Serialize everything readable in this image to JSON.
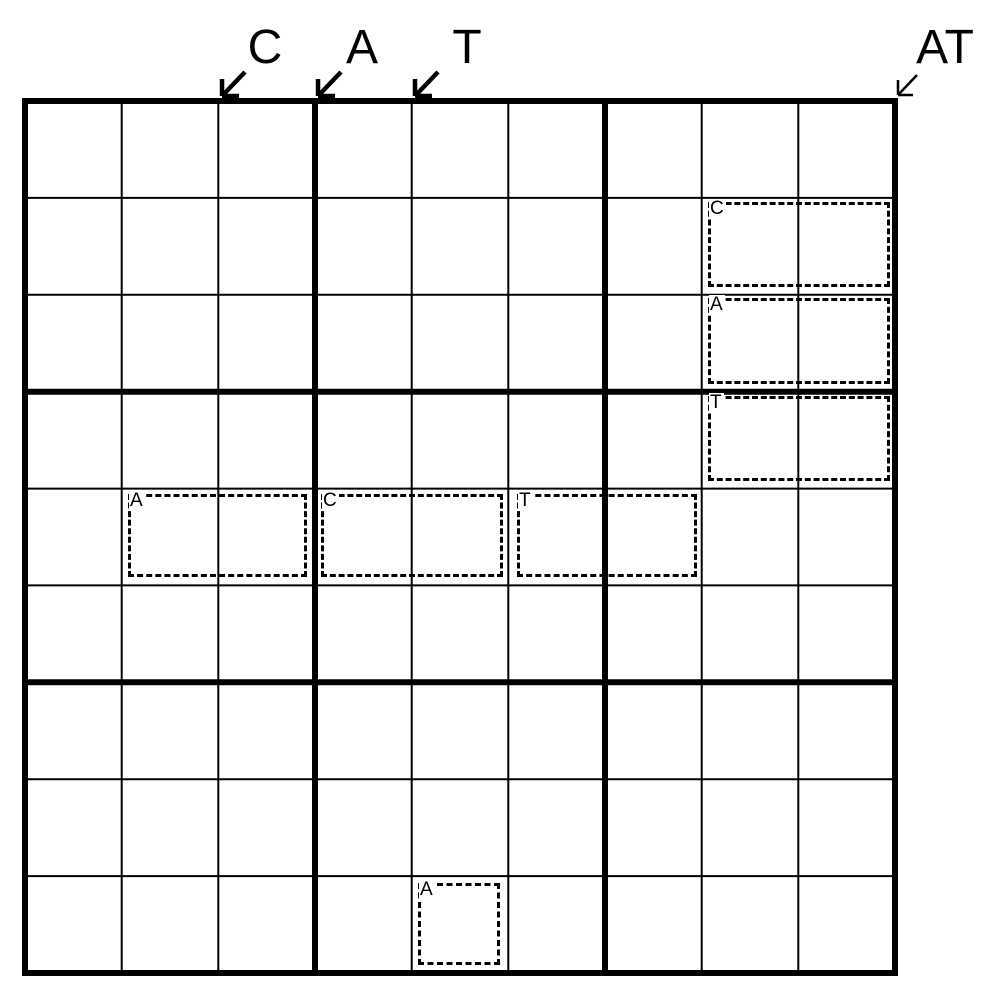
{
  "colors": {
    "ink": "#000000",
    "paper": "#ffffff"
  },
  "grid": {
    "rows": 9,
    "cols": 9,
    "box_rows": 3,
    "box_cols": 3
  },
  "column_markers": [
    {
      "label": "C"
    },
    {
      "label": "A"
    },
    {
      "label": "T"
    },
    {
      "label": "AT"
    }
  ],
  "word_boxes": [
    {
      "label": "C",
      "row": 2,
      "col_start": 8,
      "col_end": 9
    },
    {
      "label": "A",
      "row": 3,
      "col_start": 8,
      "col_end": 9
    },
    {
      "label": "T",
      "row": 4,
      "col_start": 8,
      "col_end": 9
    },
    {
      "label": "A",
      "row": 5,
      "col_start": 2,
      "col_end": 3
    },
    {
      "label": "C",
      "row": 5,
      "col_start": 4,
      "col_end": 5
    },
    {
      "label": "T",
      "row": 5,
      "col_start": 6,
      "col_end": 7
    },
    {
      "label": "A",
      "row": 9,
      "col_start": 5,
      "col_end": 5
    }
  ]
}
